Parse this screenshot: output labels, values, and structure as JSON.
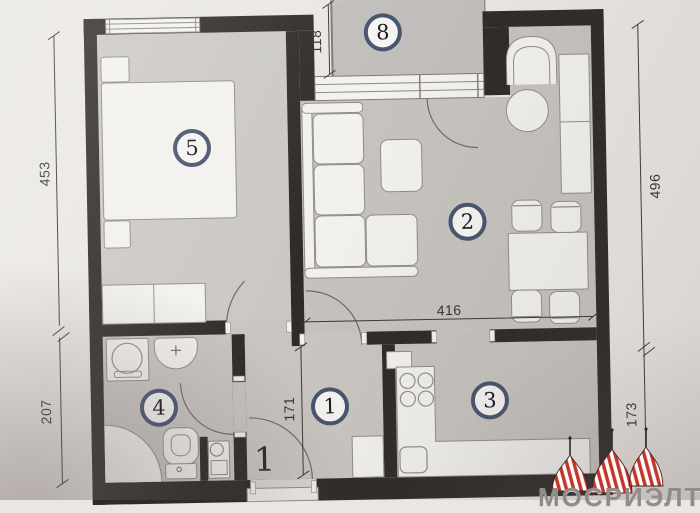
{
  "photo": {
    "description": "Apartment floor plan (photographed drawing)"
  },
  "rooms": {
    "bedroom": {
      "number": "5"
    },
    "living_room": {
      "number": "2"
    },
    "kitchen": {
      "number": "3"
    },
    "bathroom": {
      "number": "4"
    },
    "hallway": {
      "number": "1"
    },
    "balcony": {
      "number": "8"
    }
  },
  "dimensions": {
    "left_upper": "453",
    "left_lower": "207",
    "balcony_depth": "118",
    "right_upper": "496",
    "right_lower": "173",
    "living_width": "416",
    "hallway_depth": "171"
  },
  "entrance": {
    "floor_marker": "1"
  },
  "watermark": {
    "brand_text": "МОСРИЭЛТ",
    "dome_color": "#c5352b"
  },
  "palette": {
    "wall": "#2e2b28",
    "floor": "#c7c4c0",
    "paper": "#eae7e3",
    "furniture": "#f2f1ed",
    "label_ring": "#47546f"
  }
}
